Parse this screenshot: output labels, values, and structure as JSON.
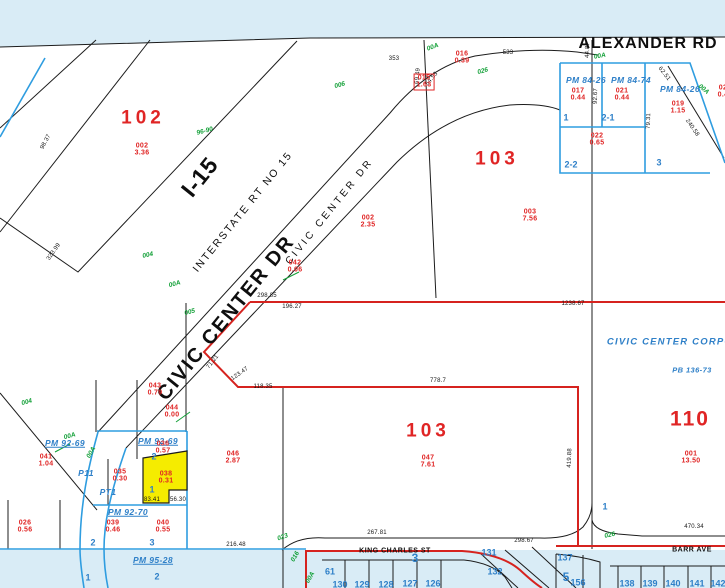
{
  "palette": {
    "paper": "#ffffff",
    "water": "#d9ecf6",
    "line_black": "#1c1c1c",
    "line_red": "#d6231f",
    "line_blue": "#2f9de0",
    "text_red": "#e02525",
    "text_blue": "#2f80c8",
    "text_green": "#13a038",
    "highlight_yellow": "#f5ec00"
  },
  "streets": [
    {
      "t": "ALEXANDER RD",
      "x": 648,
      "y": 44,
      "cls": "alexander"
    },
    {
      "t": "I-15",
      "x": 200,
      "y": 177,
      "r": -51,
      "cls": "i15"
    },
    {
      "t": "INTERSTATE RT NO 15",
      "x": 243,
      "y": 212,
      "r": -51,
      "cls": "interstate"
    },
    {
      "t": "CIVIC CENTER DR",
      "x": 226,
      "y": 318,
      "r": -51,
      "cls": "civic-big"
    },
    {
      "t": "CIVIC CENTER DR",
      "x": 330,
      "y": 212,
      "r": -51,
      "cls": "civic-small"
    },
    {
      "t": "KING CHARLES ST",
      "x": 395,
      "y": 551,
      "cls": "minor"
    },
    {
      "t": "BARR AVE",
      "x": 692,
      "y": 550,
      "cls": "minor"
    }
  ],
  "labels": {
    "red_regions": [
      {
        "t": "102",
        "x": 143,
        "y": 118
      },
      {
        "t": "103",
        "x": 497,
        "y": 159
      },
      {
        "t": "103",
        "x": 428,
        "y": 431
      },
      {
        "t": "110",
        "x": 690,
        "y": 419,
        "xl": true
      }
    ],
    "red_codes": [
      {
        "c": "002",
        "a": "3.36",
        "x": 142,
        "y": 150
      },
      {
        "c": "016",
        "a": "0.39",
        "x": 462,
        "y": 58
      },
      {
        "c": "015",
        "a": "1.63",
        "x": 424,
        "y": 82,
        "box": true
      },
      {
        "c": "017",
        "a": "0.44",
        "x": 578,
        "y": 95
      },
      {
        "c": "021",
        "a": "0.44",
        "x": 622,
        "y": 95
      },
      {
        "c": "019",
        "a": "1.15",
        "x": 678,
        "y": 108
      },
      {
        "c": "022",
        "a": "0.65",
        "x": 597,
        "y": 140
      },
      {
        "c": "02",
        "a": "0.4",
        "x": 723,
        "y": 92
      },
      {
        "c": "002",
        "a": "2.35",
        "x": 368,
        "y": 222
      },
      {
        "c": "003",
        "a": "7.56",
        "x": 530,
        "y": 216
      },
      {
        "c": "042",
        "a": "0.06",
        "x": 295,
        "y": 267
      },
      {
        "c": "043",
        "a": "0.79",
        "x": 155,
        "y": 390
      },
      {
        "c": "044",
        "a": "0.00",
        "x": 172,
        "y": 412
      },
      {
        "c": "036",
        "a": "0.57",
        "x": 163,
        "y": 448
      },
      {
        "c": "035",
        "a": "0.30",
        "x": 120,
        "y": 476
      },
      {
        "c": "041",
        "a": "1.04",
        "x": 46,
        "y": 461
      },
      {
        "c": "038",
        "a": "0.31",
        "x": 166,
        "y": 478
      },
      {
        "c": "046",
        "a": "2.87",
        "x": 233,
        "y": 458
      },
      {
        "c": "047",
        "a": "7.61",
        "x": 428,
        "y": 462
      },
      {
        "c": "026",
        "a": "0.56",
        "x": 25,
        "y": 527
      },
      {
        "c": "039",
        "a": "0.46",
        "x": 113,
        "y": 527
      },
      {
        "c": "040",
        "a": "0.55",
        "x": 163,
        "y": 527
      },
      {
        "c": "001",
        "a": "13.50",
        "x": 691,
        "y": 458
      }
    ],
    "blue_pm": [
      {
        "t": "PM 84-26",
        "x": 586,
        "y": 80
      },
      {
        "t": "PM 84-74",
        "x": 631,
        "y": 80
      },
      {
        "t": "PM 84-26",
        "x": 680,
        "y": 89
      },
      {
        "t": "PM 92-69",
        "x": 65,
        "y": 443,
        "u": true
      },
      {
        "t": "PM 92-69",
        "x": 158,
        "y": 441,
        "u": true
      },
      {
        "t": "PM 92-70",
        "x": 128,
        "y": 512,
        "u": true
      },
      {
        "t": "PM 95-28",
        "x": 153,
        "y": 560,
        "u": true
      },
      {
        "t": "P11",
        "x": 86,
        "y": 473
      },
      {
        "t": "PT1",
        "x": 108,
        "y": 492
      },
      {
        "t": "CIVIC CENTER CORPOR",
        "x": 674,
        "y": 342,
        "cls": "corp"
      },
      {
        "t": "PB 136-73",
        "x": 692,
        "y": 370,
        "cls": "plat"
      }
    ],
    "blue_lots": [
      {
        "t": "1",
        "x": 566,
        "y": 118
      },
      {
        "t": "2-1",
        "x": 608,
        "y": 118
      },
      {
        "t": "2-2",
        "x": 571,
        "y": 165
      },
      {
        "t": "3",
        "x": 659,
        "y": 163
      },
      {
        "t": "2",
        "x": 154,
        "y": 457
      },
      {
        "t": "1",
        "x": 152,
        "y": 490
      },
      {
        "t": "2",
        "x": 93,
        "y": 543
      },
      {
        "t": "3",
        "x": 152,
        "y": 543
      },
      {
        "t": "1",
        "x": 88,
        "y": 578
      },
      {
        "t": "2",
        "x": 157,
        "y": 577
      },
      {
        "t": "1",
        "x": 605,
        "y": 507
      },
      {
        "t": "61",
        "x": 330,
        "y": 572
      },
      {
        "t": "3",
        "x": 415,
        "y": 558,
        "big": true
      },
      {
        "t": "131",
        "x": 489,
        "y": 553
      },
      {
        "t": "132",
        "x": 495,
        "y": 572
      },
      {
        "t": "5",
        "x": 566,
        "y": 577,
        "big": true
      },
      {
        "t": "137",
        "x": 565,
        "y": 558
      },
      {
        "t": "156",
        "x": 578,
        "y": 583
      },
      {
        "t": "130",
        "x": 340,
        "y": 585
      },
      {
        "t": "129",
        "x": 362,
        "y": 585
      },
      {
        "t": "128",
        "x": 386,
        "y": 585
      },
      {
        "t": "127",
        "x": 410,
        "y": 584
      },
      {
        "t": "126",
        "x": 433,
        "y": 584
      },
      {
        "t": "138",
        "x": 627,
        "y": 584
      },
      {
        "t": "139",
        "x": 650,
        "y": 584
      },
      {
        "t": "140",
        "x": 673,
        "y": 584
      },
      {
        "t": "141",
        "x": 697,
        "y": 584
      },
      {
        "t": "142",
        "x": 718,
        "y": 584
      }
    ],
    "dims": [
      {
        "t": "533",
        "x": 508,
        "y": 53
      },
      {
        "t": "353",
        "x": 394,
        "y": 59
      },
      {
        "t": "69.49",
        "x": 418,
        "y": 76,
        "r": -85
      },
      {
        "t": "54.53",
        "x": 432,
        "y": 79,
        "r": -50
      },
      {
        "t": "44.87",
        "x": 588,
        "y": 50,
        "r": -88
      },
      {
        "t": "92.67",
        "x": 596,
        "y": 96,
        "r": -88
      },
      {
        "t": "79.31",
        "x": 649,
        "y": 121,
        "r": -88
      },
      {
        "t": "62.51",
        "x": 664,
        "y": 74,
        "r": 52
      },
      {
        "t": "240.58",
        "x": 692,
        "y": 128,
        "r": 55
      },
      {
        "t": "298.85",
        "x": 267,
        "y": 296
      },
      {
        "t": "196.27",
        "x": 292,
        "y": 307
      },
      {
        "t": "1238.67",
        "x": 573,
        "y": 304
      },
      {
        "t": "778.7",
        "x": 438,
        "y": 381
      },
      {
        "t": "71.21",
        "x": 213,
        "y": 362,
        "r": -52
      },
      {
        "t": "123.47",
        "x": 240,
        "y": 374,
        "r": -35
      },
      {
        "t": "118.35",
        "x": 263,
        "y": 387
      },
      {
        "t": "419.88",
        "x": 570,
        "y": 458,
        "r": -88
      },
      {
        "t": "98.37",
        "x": 46,
        "y": 142,
        "r": -62
      },
      {
        "t": "323.99",
        "x": 54,
        "y": 252,
        "r": -55
      },
      {
        "t": "267.81",
        "x": 377,
        "y": 533
      },
      {
        "t": "216.48",
        "x": 236,
        "y": 545
      },
      {
        "t": "298.67",
        "x": 524,
        "y": 541
      },
      {
        "t": "470.34",
        "x": 694,
        "y": 527
      },
      {
        "t": "83.41",
        "x": 152,
        "y": 500
      },
      {
        "t": "56.30",
        "x": 178,
        "y": 500
      }
    ],
    "green_codes": [
      {
        "t": "006",
        "x": 340,
        "y": 86,
        "r": -15
      },
      {
        "t": "96-90",
        "x": 205,
        "y": 132,
        "r": -15
      },
      {
        "t": "004",
        "x": 148,
        "y": 256,
        "r": -12
      },
      {
        "t": "026",
        "x": 483,
        "y": 72,
        "r": -15
      },
      {
        "t": "00A",
        "x": 600,
        "y": 57,
        "r": -10
      },
      {
        "t": "00A",
        "x": 703,
        "y": 90,
        "r": 40
      },
      {
        "t": "00A",
        "x": 433,
        "y": 48,
        "r": -20
      },
      {
        "t": "00A",
        "x": 175,
        "y": 285,
        "r": -15
      },
      {
        "t": "005",
        "x": 190,
        "y": 313,
        "r": -15
      },
      {
        "t": "004",
        "x": 27,
        "y": 403,
        "r": -15
      },
      {
        "t": "00A",
        "x": 70,
        "y": 437,
        "r": -15
      },
      {
        "t": "00A",
        "x": 92,
        "y": 453,
        "r": -60
      },
      {
        "t": "023",
        "x": 283,
        "y": 538,
        "r": -20
      },
      {
        "t": "016",
        "x": 296,
        "y": 557,
        "r": -60
      },
      {
        "t": "00A",
        "x": 311,
        "y": 578,
        "r": -60
      },
      {
        "t": "026",
        "x": 610,
        "y": 536,
        "r": -12
      }
    ]
  }
}
